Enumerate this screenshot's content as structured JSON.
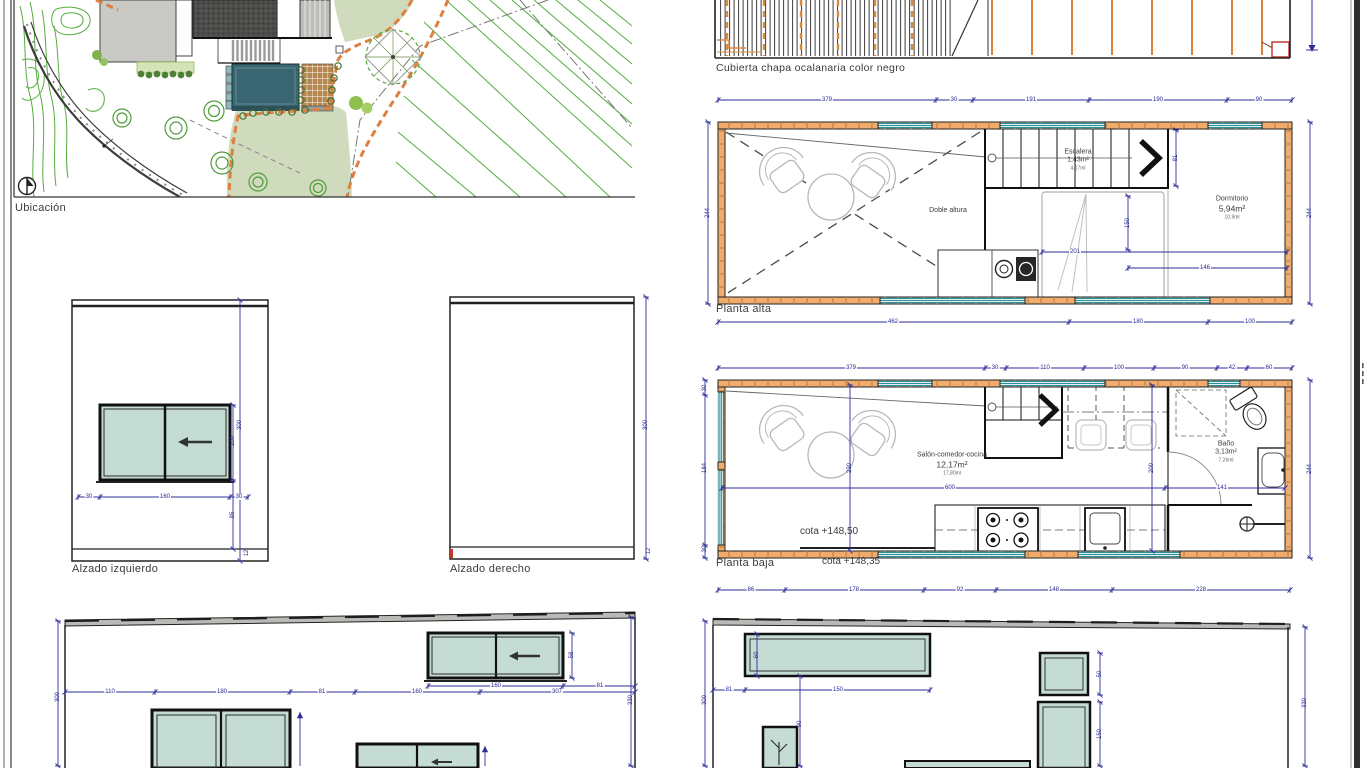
{
  "labels": {
    "ubicacion": "Ubicación",
    "cubierta": "Cubierta chapa ocalanaria color negro",
    "planta_alta": "Planta alta",
    "planta_baja": "Planta baja",
    "alzado_izquierdo": "Alzado izquierdo",
    "alzado_derecho": "Alzado derecho",
    "cota_interior": "cota +148,50",
    "cota_exterior": "cota +148,35"
  },
  "rooms": {
    "escalera": {
      "name": "Escalera",
      "area": "1,43m²",
      "length": "4,17ml"
    },
    "doble_altura": "Doble altura",
    "dormitorio": {
      "name": "Dormitorio",
      "area": "5,94m²",
      "length": "10,9ml"
    },
    "salon": {
      "name": "Salón-comedor-cocina",
      "area": "12,17m²",
      "length": "17,80ml"
    },
    "bano": {
      "name": "Baño",
      "area": "3,13m²",
      "length": "7,26ml"
    }
  },
  "dims": {
    "pa_top": [
      "379",
      "30",
      "191",
      "190",
      "90"
    ],
    "pa_bottom": [
      "462",
      "180",
      "100"
    ],
    "pa_side": "244",
    "pa_inner": {
      "a": "201",
      "b": "146",
      "c": "150",
      "d": "81"
    },
    "pb_top": [
      "379",
      "30",
      "110",
      "100",
      "90",
      "42",
      "60"
    ],
    "pb_bottom": [
      "86",
      "178",
      "92",
      "148",
      "228"
    ],
    "pb_side": "244",
    "pb_left": [
      "30",
      "184",
      "30"
    ],
    "pb_inner": {
      "a": "600",
      "b": "141",
      "c": "230",
      "d": "200"
    },
    "ai": {
      "v_total": "300",
      "win_h": "100",
      "sill": "85",
      "base": "12",
      "bottom": [
        "30",
        "160",
        "30"
      ]
    },
    "ad": {
      "v_total": "300",
      "base": "12"
    },
    "ef": {
      "top": [
        "110",
        "180",
        "81",
        "160",
        "307"
      ],
      "win_w": "160",
      "win_r": "81",
      "win_h": "58",
      "left": "300",
      "right": "330"
    },
    "er": {
      "a": "81",
      "b": "150",
      "win_h": "60",
      "drop": "90",
      "small_h": "50",
      "tall_h": "150",
      "left": "300",
      "right": "330"
    }
  },
  "colors": {
    "wall": "#f0ab6d",
    "window_teal": "#2e8f96",
    "dimension_blue": "#2e2e99",
    "glass": "#c5dcd4",
    "pool": "#3a6672",
    "lawn": "#cfdbbc",
    "contour_green": "#55ac3f",
    "path_orange": "#dd8040",
    "roof_dark": "#4b4b49",
    "marker_red": "#c0392b"
  }
}
